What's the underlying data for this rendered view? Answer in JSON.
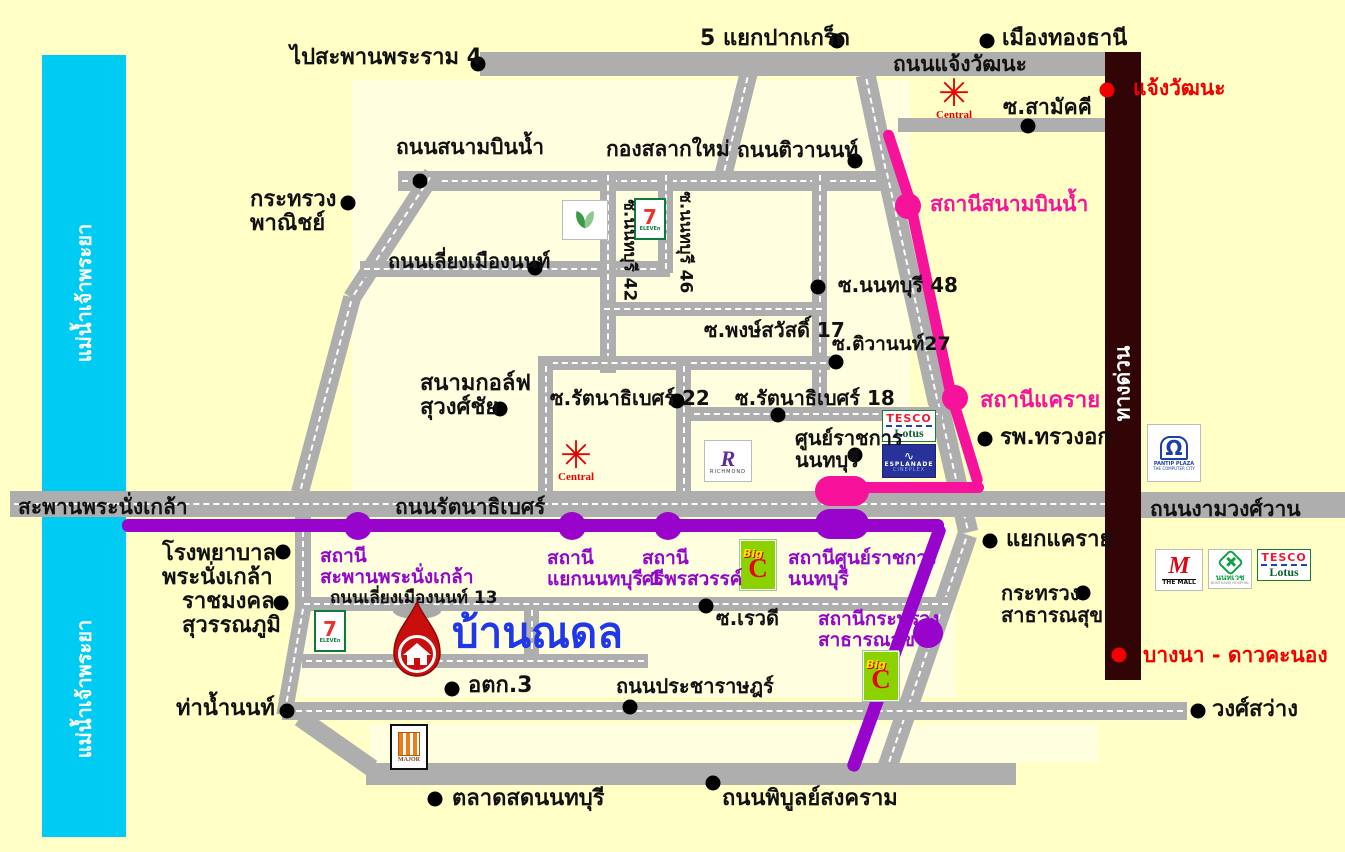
{
  "title": "บ้านณดล",
  "colors": {
    "background": "#FFFFC6",
    "block": "#FFFEDF",
    "river": "#00CBF2",
    "road": "#AEAEAE",
    "pink_line": "#F7129B",
    "purple_line": "#9804CC",
    "expressway": "#310505",
    "house_text": "#2038E8",
    "red_text": "#F20000",
    "pin_red": "#C90E0E"
  },
  "house": {
    "label": "บ้านณดล"
  },
  "blocks": [
    [
      352,
      80,
      558,
      518
    ],
    [
      300,
      525,
      655,
      172
    ],
    [
      370,
      724,
      728,
      38
    ]
  ],
  "river": {
    "name": "chao-phraya-river",
    "x": 42,
    "y": 55,
    "w": 84,
    "h": 782
  },
  "expressway": {
    "name": "expressway",
    "x": 1105,
    "y": 52,
    "w": 36,
    "h": 628
  },
  "roads": [
    {
      "n": "changwattana",
      "x": 480,
      "y": 52,
      "w": 632,
      "h": 24
    },
    {
      "n": "soi-samakkhi",
      "x": 898,
      "y": 118,
      "w": 212,
      "h": 14
    },
    {
      "n": "changwattana-branch",
      "x": 727,
      "y": 72,
      "w": 18,
      "h": 104,
      "r": 14,
      "d": 1
    },
    {
      "n": "sanambinnam",
      "x": 398,
      "y": 171,
      "w": 492,
      "h": 20,
      "d": 1
    },
    {
      "n": "tiwanon-1",
      "x": 866,
      "y": 74,
      "w": 20,
      "h": 100,
      "r": -12,
      "d": 1
    },
    {
      "n": "tiwanon-2",
      "x": 902,
      "y": 166,
      "w": 20,
      "h": 240,
      "r": -12.5,
      "d": 1
    },
    {
      "n": "tiwanon-3",
      "x": 943,
      "y": 398,
      "w": 20,
      "h": 136,
      "r": -13,
      "d": 1
    },
    {
      "n": "tiwanon-4",
      "x": 916,
      "y": 528,
      "w": 20,
      "h": 254,
      "r": 19,
      "d": 1
    },
    {
      "n": "liangmueang-diag-1",
      "x": 383,
      "y": 162,
      "w": 18,
      "h": 148,
      "r": 33,
      "d": 1
    },
    {
      "n": "liangmueang-diag-2",
      "x": 317,
      "y": 294,
      "w": 18,
      "h": 202,
      "r": 15,
      "d": 1
    },
    {
      "n": "liangmueangnon",
      "x": 360,
      "y": 261,
      "w": 310,
      "h": 16,
      "d": 1
    },
    {
      "n": "soi-nonthaburi-42",
      "x": 600,
      "y": 171,
      "w": 16,
      "h": 202,
      "d": 1
    },
    {
      "n": "soi-nonthaburi-46",
      "x": 658,
      "y": 171,
      "w": 15,
      "h": 102,
      "d": 1
    },
    {
      "n": "soi-nonthaburi-48",
      "x": 812,
      "y": 171,
      "w": 15,
      "h": 246,
      "d": 1
    },
    {
      "n": "soi-phongsawat",
      "x": 600,
      "y": 302,
      "w": 226,
      "h": 14,
      "d": 1
    },
    {
      "n": "mid-horizontal",
      "x": 538,
      "y": 356,
      "w": 292,
      "h": 14,
      "d": 1
    },
    {
      "n": "mid-vertical-1",
      "x": 538,
      "y": 362,
      "w": 15,
      "h": 136,
      "d": 1
    },
    {
      "n": "mid-vertical-2",
      "x": 676,
      "y": 362,
      "w": 15,
      "h": 136,
      "d": 1
    },
    {
      "n": "soi-rattanathibet-18",
      "x": 690,
      "y": 407,
      "w": 252,
      "h": 14,
      "d": 1
    },
    {
      "n": "rattanathibet",
      "x": 10,
      "y": 491,
      "w": 1130,
      "h": 26,
      "d": 1
    },
    {
      "n": "ngamwongwan",
      "x": 1140,
      "y": 492,
      "w": 205,
      "h": 26
    },
    {
      "n": "phranangklao-south",
      "x": 295,
      "y": 517,
      "w": 16,
      "h": 94,
      "d": 1
    },
    {
      "n": "liangmueangnon-13",
      "x": 300,
      "y": 597,
      "w": 652,
      "h": 14,
      "d": 1
    },
    {
      "n": "house-block-v",
      "x": 524,
      "y": 606,
      "w": 15,
      "h": 58,
      "d": 1
    },
    {
      "n": "house-block-h",
      "x": 302,
      "y": 654,
      "w": 346,
      "h": 14,
      "d": 1
    },
    {
      "n": "thanamnon-v",
      "x": 286,
      "y": 604,
      "w": 16,
      "h": 112,
      "r": 10,
      "d": 1
    },
    {
      "n": "pracharat-wongsawang",
      "x": 282,
      "y": 702,
      "w": 905,
      "h": 18,
      "d": 1
    },
    {
      "n": "phibunsongkhram",
      "x": 366,
      "y": 763,
      "w": 650,
      "h": 22
    },
    {
      "n": "phibun-curve",
      "x": 327,
      "y": 699,
      "w": 18,
      "h": 88,
      "r": -55
    }
  ],
  "transit": {
    "pink": [
      {
        "n": "pink-line-1",
        "x": 894,
        "y": 128,
        "w": 11,
        "h": 82,
        "r": -18
      },
      {
        "n": "pink-line-2",
        "x": 926,
        "y": 206,
        "w": 11,
        "h": 194,
        "r": -12
      },
      {
        "n": "pink-line-3",
        "x": 960,
        "y": 396,
        "w": 11,
        "h": 91,
        "r": -17
      },
      {
        "n": "pink-line-4",
        "x": 844,
        "y": 482,
        "w": 140,
        "h": 11
      }
    ],
    "purple": [
      {
        "n": "purple-line-1",
        "x": 122,
        "y": 519,
        "w": 822,
        "h": 13
      },
      {
        "n": "purple-line-2",
        "x": 890,
        "y": 517,
        "w": 13,
        "h": 262,
        "r": 20
      }
    ]
  },
  "stations": [
    {
      "n": "station-sanambinnam",
      "c": "pink",
      "x": 908,
      "y": 206,
      "s": 26
    },
    {
      "n": "station-khaerai",
      "c": "pink",
      "x": 955,
      "y": 398,
      "s": 26
    },
    {
      "n": "terminal-pink-sunratchakan",
      "c": "pink",
      "cap": 1,
      "x": 815,
      "y": 476,
      "w": 54,
      "h": 30
    },
    {
      "n": "station-saphan-phranangklao",
      "c": "purple",
      "x": 358,
      "y": 526,
      "s": 28
    },
    {
      "n": "station-yaek-nonthaburi-1",
      "c": "purple",
      "x": 572,
      "y": 526,
      "s": 28
    },
    {
      "n": "station-si-phonsawan",
      "c": "purple",
      "x": 668,
      "y": 526,
      "s": 28
    },
    {
      "n": "terminal-purple-sunratchakan",
      "c": "purple",
      "cap": 1,
      "x": 815,
      "y": 509,
      "w": 54,
      "h": 30
    },
    {
      "n": "station-krasuang-satharanasuk",
      "c": "purple",
      "x": 928,
      "y": 633,
      "s": 30
    }
  ],
  "dots": [
    [
      478,
      64
    ],
    [
      837,
      41
    ],
    [
      987,
      41
    ],
    [
      1028,
      126
    ],
    [
      348,
      203
    ],
    [
      420,
      181
    ],
    [
      855,
      161
    ],
    [
      535,
      268
    ],
    [
      818,
      287
    ],
    [
      836,
      362
    ],
    [
      500,
      409
    ],
    [
      677,
      401
    ],
    [
      778,
      415
    ],
    [
      855,
      455
    ],
    [
      985,
      439
    ],
    [
      990,
      541
    ],
    [
      1083,
      593
    ],
    [
      283,
      552
    ],
    [
      281,
      603
    ],
    [
      287,
      711
    ],
    [
      706,
      606
    ],
    [
      452,
      689
    ],
    [
      630,
      707
    ],
    [
      1198,
      711
    ],
    [
      435,
      799
    ],
    [
      713,
      783
    ]
  ],
  "red_dots": [
    [
      1107,
      90
    ],
    [
      1119,
      655
    ]
  ],
  "labels": [
    {
      "n": "go-rama4-bridge",
      "text": "ไปสะพานพระราม 4",
      "x": 290,
      "y": 46,
      "s": 22
    },
    {
      "n": "pak-kret-junction",
      "text": "5 แยกปากเกร็ด",
      "x": 700,
      "y": 27,
      "s": 22
    },
    {
      "n": "mueang-thong-thani",
      "text": "เมืองทองธานี",
      "x": 1002,
      "y": 27,
      "s": 22
    },
    {
      "n": "road-changwattana",
      "text": "ถนนแจ้งวัฒนะ",
      "x": 893,
      "y": 53,
      "s": 21
    },
    {
      "n": "soi-samakkhi",
      "text": "ซ.สามัคคี",
      "x": 1003,
      "y": 96,
      "s": 21
    },
    {
      "n": "exit-changwattana",
      "text": "แจ้งวัฒนะ",
      "x": 1133,
      "y": 77,
      "s": 21,
      "c": "red"
    },
    {
      "n": "road-sanambinnam",
      "text": "ถนนสนามบินน้ำ",
      "x": 396,
      "y": 136,
      "s": 21
    },
    {
      "n": "kong-salak-mai",
      "text": "กองสลากใหม่",
      "x": 606,
      "y": 138,
      "s": 21
    },
    {
      "n": "road-tiwanon",
      "text": "ถนนติวานนท์",
      "x": 737,
      "y": 139,
      "s": 21
    },
    {
      "n": "commerce-ministry",
      "text": "กระทรวง\nพาณิชย์",
      "x": 250,
      "y": 188,
      "s": 22
    },
    {
      "n": "station-sanambinnam",
      "text": "สถานีสนามบินน้ำ",
      "x": 930,
      "y": 193,
      "s": 21,
      "c": "pink"
    },
    {
      "n": "road-liangmueangnon",
      "text": "ถนนเลี่ยงเมืองนนท์",
      "x": 388,
      "y": 250,
      "s": 20
    },
    {
      "n": "soi-nonthaburi-48",
      "text": "ซ.นนทบุรี 48",
      "x": 838,
      "y": 274,
      "s": 20
    },
    {
      "n": "soi-phongsawat-17",
      "text": "ซ.พงษ์สวัสดิ์ 17",
      "x": 704,
      "y": 319,
      "s": 20
    },
    {
      "n": "soi-tiwanon-27",
      "text": "ซ.ติวานนท์27",
      "x": 832,
      "y": 334,
      "s": 19
    },
    {
      "n": "golf-course",
      "text": "สนามกอล์ฟ\nสุวงศ์ชัย",
      "x": 420,
      "y": 372,
      "s": 22
    },
    {
      "n": "soi-rattanathibet-22",
      "text": "ซ.รัตนาธิเบศร์ 22",
      "x": 550,
      "y": 387,
      "s": 20
    },
    {
      "n": "soi-rattanathibet-18",
      "text": "ซ.รัตนาธิเบศร์ 18",
      "x": 735,
      "y": 387,
      "s": 20
    },
    {
      "n": "station-khaerai",
      "text": "สถานีแคราย",
      "x": 980,
      "y": 389,
      "s": 22,
      "c": "pink"
    },
    {
      "n": "gov-center-nonthaburi",
      "text": "ศูนย์ราชการ\nนนทบุรี",
      "x": 795,
      "y": 427,
      "s": 20
    },
    {
      "n": "chest-hospital",
      "text": "รพ.ทรวงอก",
      "x": 1000,
      "y": 426,
      "s": 22
    },
    {
      "n": "phranangklao-bridge",
      "text": "สะพานพระนั่งเกล้า",
      "x": 18,
      "y": 496,
      "s": 21
    },
    {
      "n": "road-rattanathibet",
      "text": "ถนนรัตนาธิเบศร์",
      "x": 395,
      "y": 496,
      "s": 21
    },
    {
      "n": "road-ngamwongwan",
      "text": "ถนนงามวงศ์วาน",
      "x": 1150,
      "y": 498,
      "s": 21
    },
    {
      "n": "yaek-khaerai",
      "text": "แยกแคราย",
      "x": 1006,
      "y": 528,
      "s": 22
    },
    {
      "n": "phranangklao-hospital",
      "text": "โรงพยาบาล\nพระนั่งเกล้า",
      "x": 162,
      "y": 542,
      "s": 22
    },
    {
      "n": "station-saphan-phranangklao",
      "text": "สถานี\nสะพานพระนั่งเกล้า",
      "x": 320,
      "y": 546,
      "s": 19,
      "c": "purple"
    },
    {
      "n": "station-yaek-nonthaburi-1",
      "text": "สถานี\nแยกนนทบุรี 1",
      "x": 547,
      "y": 548,
      "s": 19,
      "c": "purple"
    },
    {
      "n": "station-si-phonsawan",
      "text": "สถานี\nศรีพรสวรรค์",
      "x": 642,
      "y": 548,
      "s": 19,
      "c": "purple"
    },
    {
      "n": "station-sunratchakan",
      "text": "สถานีศูนย์ราชการ\nนนทบุรี",
      "x": 788,
      "y": 548,
      "s": 19,
      "c": "purple"
    },
    {
      "n": "health-ministry",
      "text": "กระทรวง\nสาธารณสุข",
      "x": 1001,
      "y": 582,
      "s": 20
    },
    {
      "n": "rajamangala-suvarnabhumi",
      "text": "ราชมงคล\nสุวรรณภูมิ",
      "x": 182,
      "y": 590,
      "s": 22
    },
    {
      "n": "road-liangmueangnon-13",
      "text": "ถนนเลี่ยงเมืองนนท์ 13",
      "x": 330,
      "y": 589,
      "s": 17
    },
    {
      "n": "baan-nadol",
      "text": "บ้านณดล",
      "x": 452,
      "y": 610,
      "s": 42,
      "c": "blue"
    },
    {
      "n": "station-health-ministry",
      "text": "สถานีกระทรวง\nสาธารณสุข",
      "x": 818,
      "y": 609,
      "s": 19,
      "c": "purple"
    },
    {
      "n": "soi-rewadi",
      "text": "ซ.เรวดี",
      "x": 716,
      "y": 607,
      "s": 20
    },
    {
      "n": "exit-bangna-daokhanong",
      "text": "บางนา - ดาวคะนอง",
      "x": 1143,
      "y": 644,
      "s": 21,
      "c": "red"
    },
    {
      "n": "otk-3",
      "text": "อตก.3",
      "x": 468,
      "y": 674,
      "s": 22
    },
    {
      "n": "road-pracharat",
      "text": "ถนนประชาราษฎร์",
      "x": 616,
      "y": 675,
      "s": 20
    },
    {
      "n": "tha-nam-non",
      "text": "ท่าน้ำนนท์",
      "x": 176,
      "y": 697,
      "s": 22
    },
    {
      "n": "wongsawang",
      "text": "วงศ์สว่าง",
      "x": 1212,
      "y": 698,
      "s": 22
    },
    {
      "n": "talat-sot-nonthaburi",
      "text": "ตลาดสดนนทบุรี",
      "x": 452,
      "y": 787,
      "s": 22
    },
    {
      "n": "road-phibunsongkhram",
      "text": "ถนนพิบูลย์สงคราม",
      "x": 722,
      "y": 787,
      "s": 22
    },
    {
      "n": "soi-nonthaburi-42",
      "text": "ซ.นนทบุรี 42",
      "x": 629,
      "y": 255,
      "s": 17,
      "rot": 90
    },
    {
      "n": "soi-nonthaburi-46",
      "text": "ซ.นนทบุรี 46",
      "x": 685,
      "y": 247,
      "s": 17,
      "rot": 90
    },
    {
      "n": "expressway",
      "text": "ทางด่วน",
      "x": 1123,
      "y": 386,
      "s": 21,
      "rot": -90,
      "c": "white"
    },
    {
      "n": "chao-phraya-river-upper",
      "text": "แม่น้ำเจ้าพระยา",
      "x": 84,
      "y": 296,
      "s": 20,
      "rot": -90,
      "c": "white"
    },
    {
      "n": "chao-phraya-river-lower",
      "text": "แม่น้ำเจ้าพระยา",
      "x": 84,
      "y": 692,
      "s": 20,
      "rot": -90,
      "c": "white"
    }
  ],
  "logo_text": {
    "central": "Central",
    "seven": "7",
    "seven_sub": "ELEVEn",
    "tesco": "TESCO",
    "lotus": "Lotus",
    "esplanade": "ESPLANADE",
    "cineplex": "CINEPLEX",
    "richmond_r": "R",
    "richmond": "RICHMOND",
    "bigc_big": "Big",
    "bigc_c": "C",
    "themall_m": "M",
    "themall": "THE MALL",
    "nonthavej": "นนทเวช",
    "nonthavej_sub": "NONTHAVEJ HOSPITAL",
    "pantip1": "PANTIP PLAZA",
    "pantip2": "THE COMPUTER CITY",
    "major": "MAJOR"
  },
  "logos": [
    {
      "t": "central",
      "x": 936,
      "y": 76
    },
    {
      "t": "central",
      "x": 558,
      "y": 438
    },
    {
      "t": "seven",
      "x": 634,
      "y": 198
    },
    {
      "t": "leaf",
      "x": 562,
      "y": 200
    },
    {
      "t": "seven",
      "x": 314,
      "y": 610
    },
    {
      "t": "tesco",
      "x": 882,
      "y": 410
    },
    {
      "t": "esplanade",
      "x": 882,
      "y": 444
    },
    {
      "t": "richmond",
      "x": 704,
      "y": 440
    },
    {
      "t": "bigc",
      "x": 740,
      "y": 540
    },
    {
      "t": "bigc",
      "x": 863,
      "y": 651
    },
    {
      "t": "themall",
      "x": 1155,
      "y": 549
    },
    {
      "t": "nonthavej",
      "x": 1208,
      "y": 549
    },
    {
      "t": "tesco",
      "x": 1257,
      "y": 549
    },
    {
      "t": "pantip",
      "x": 1147,
      "y": 424
    },
    {
      "t": "major",
      "x": 390,
      "y": 724
    }
  ]
}
